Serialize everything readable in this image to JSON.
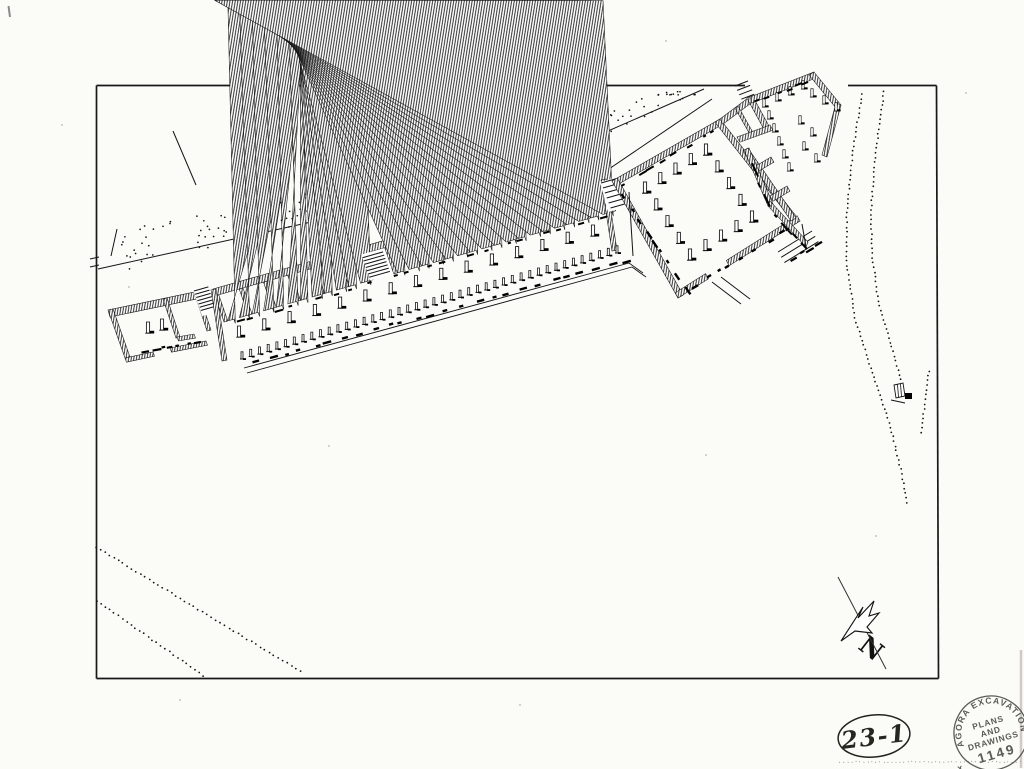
{
  "annotations": {
    "drawing_number": "23-1",
    "north_label": "N"
  },
  "stamp": {
    "ring_text": "AGORA EXCAVATIONS",
    "line1": "PLANS",
    "line2": "AND",
    "line3": "DRAWINGS",
    "number": "1149",
    "mark": "x"
  },
  "colors": {
    "ink": "#141414",
    "paper": "#fbfbf8",
    "stamp_ink": "#4b4b44"
  }
}
